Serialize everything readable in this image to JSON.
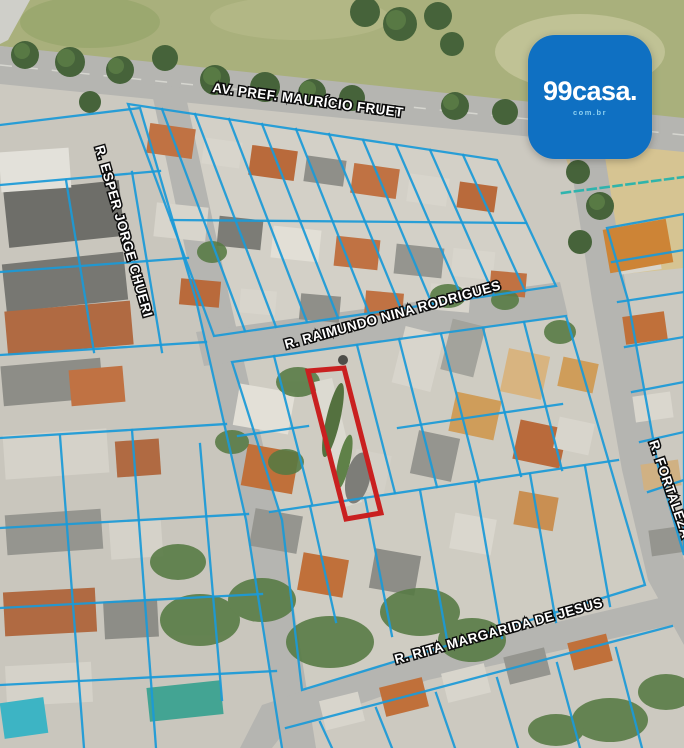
{
  "theme": {
    "parcel-line": "#1b9ad7",
    "highlight": "#c92020",
    "logo-bg": "#0f70c2",
    "road": "#b5b5b1",
    "grass": "#a9b07c"
  },
  "logo": {
    "text": "99casa.",
    "tagline": "com.br"
  },
  "map": {
    "streets": [
      {
        "id": "av-pref-mauricio-fruet",
        "label": "AV. PREF. MAURÍCIO FRUET"
      },
      {
        "id": "r-esper-jorge-chueri",
        "label": "R. ESPER JORGE CHUERI"
      },
      {
        "id": "r-raimundo-nina-rodrigues",
        "label": "R. RAIMUNDO NINA RODRIGUES"
      },
      {
        "id": "r-fortaleza",
        "label": "R. FORTALEZA"
      },
      {
        "id": "r-rita-margarida-de-jesus",
        "label": "R. RITA MARGARIDA DE JESUS"
      }
    ]
  }
}
